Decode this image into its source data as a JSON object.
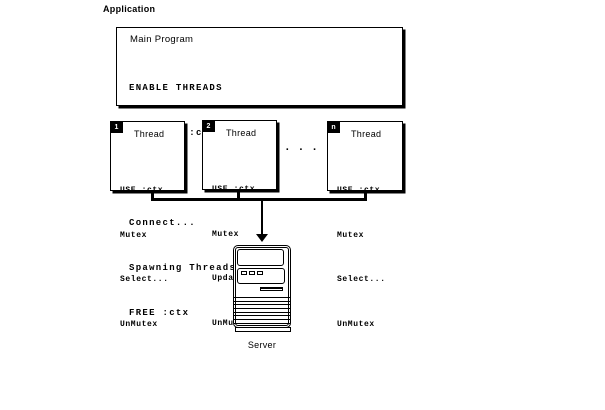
{
  "app_label": "Application",
  "main_program": {
    "title": "Main Program",
    "code": [
      "ENABLE THREADS",
      "ALLOCATE :ctx",
      "USE :ctx",
      "Connect...",
      "Spawning Threads...",
      "FREE :ctx"
    ]
  },
  "threads": [
    {
      "badge": "1",
      "label": "Thread",
      "code": [
        "USE :ctx",
        "Mutex",
        "Select...",
        "UnMutex"
      ]
    },
    {
      "badge": "2",
      "label": "Thread",
      "code": [
        "USE :ctx",
        "Mutex",
        "Update...",
        "UnMutex"
      ]
    },
    {
      "badge": "n",
      "label": "Thread",
      "code": [
        "USE :ctx",
        "Mutex",
        "Select...",
        "UnMutex"
      ]
    }
  ],
  "ellipsis": "...",
  "server": {
    "label": "Server"
  },
  "colors": {
    "ink": "#000000",
    "background": "#ffffff"
  }
}
